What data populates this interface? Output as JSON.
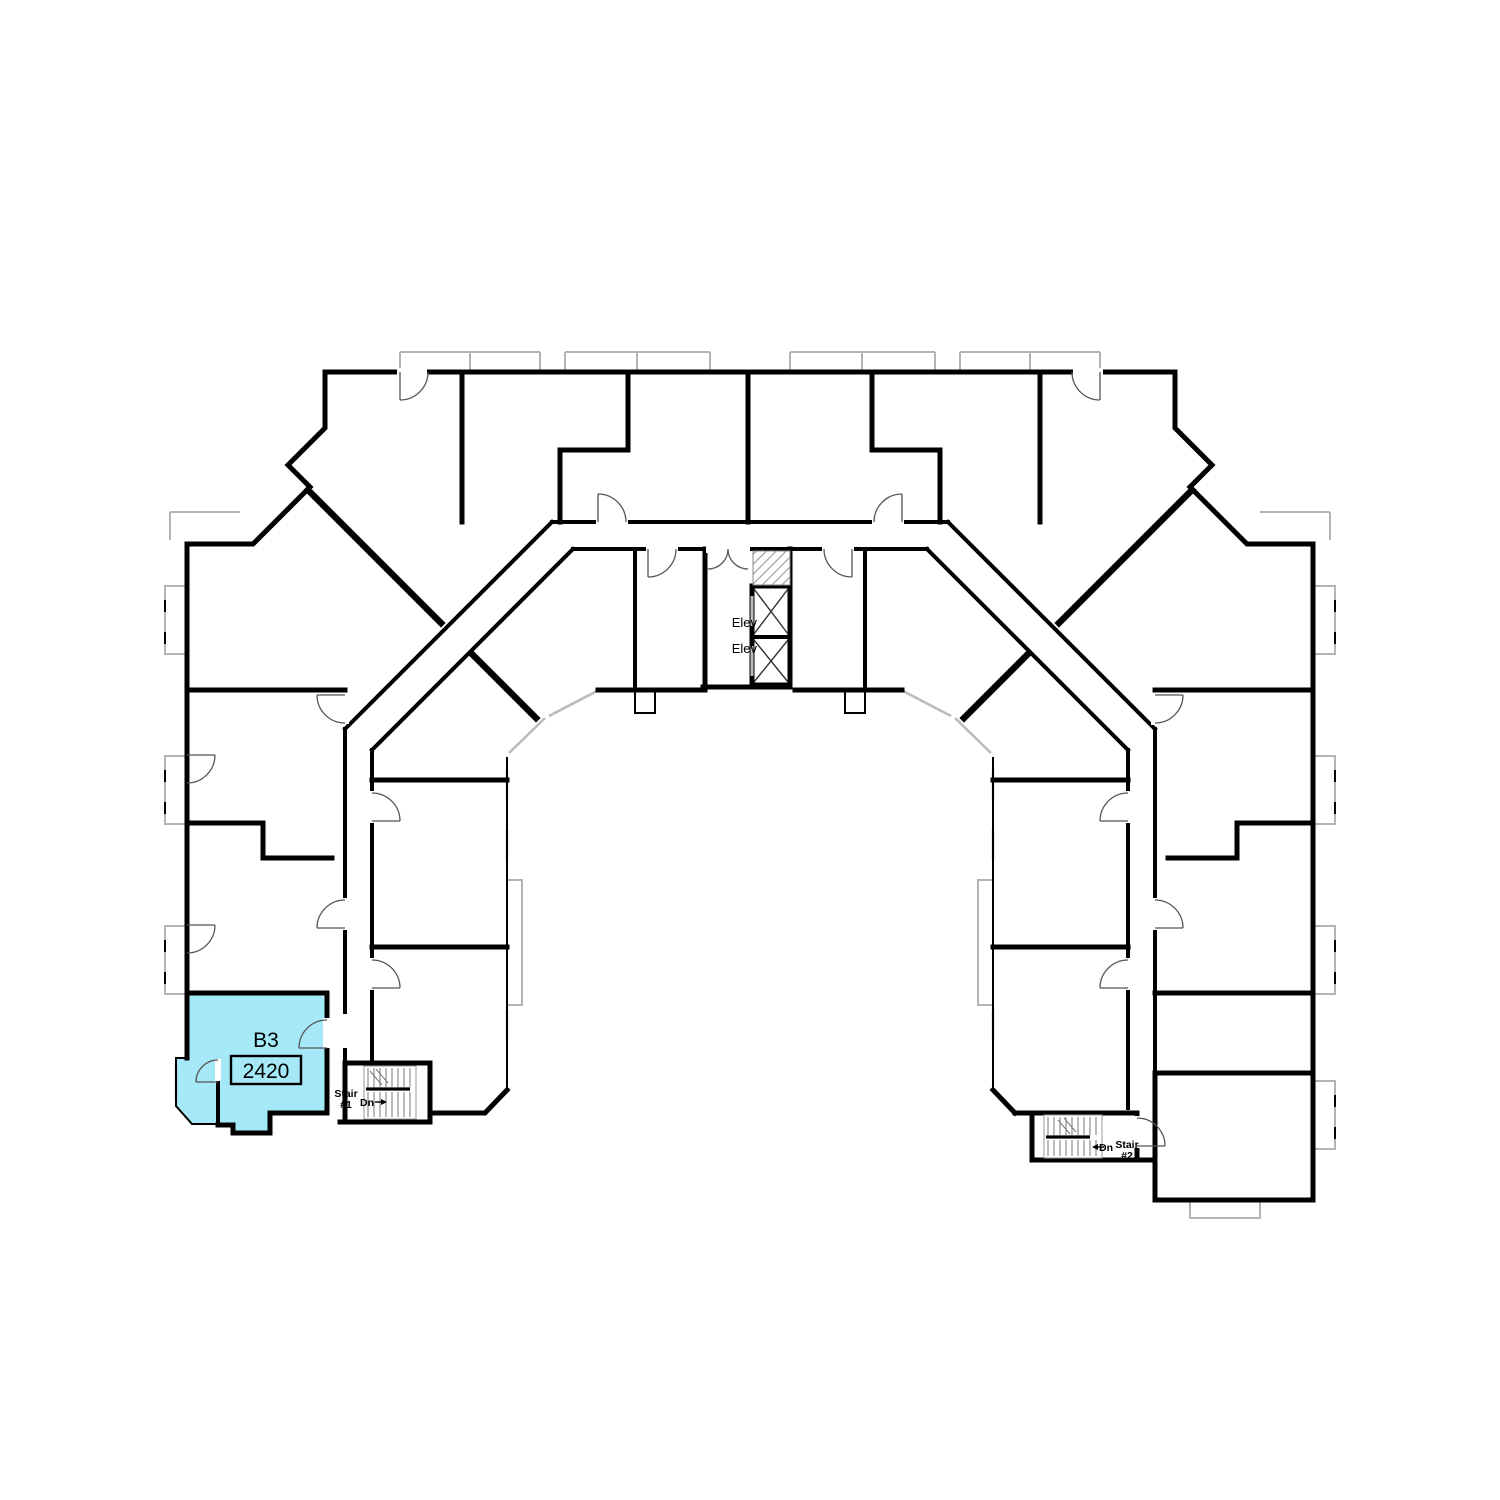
{
  "plan": {
    "colors": {
      "highlight": "#A5E8F8",
      "wall": "#000000",
      "window": "#B3B3B3",
      "door_arc": "#555555"
    },
    "highlighted_unit": {
      "plan_code": "B3",
      "unit_number": "2420"
    },
    "elevator_labels": [
      "Elev",
      "Elev"
    ],
    "stair1": {
      "line1": "Stair",
      "line2": "#1",
      "dn": "Dn"
    },
    "stair2": {
      "line1": "Stair",
      "line2": "#2",
      "dn": "Dn"
    }
  }
}
